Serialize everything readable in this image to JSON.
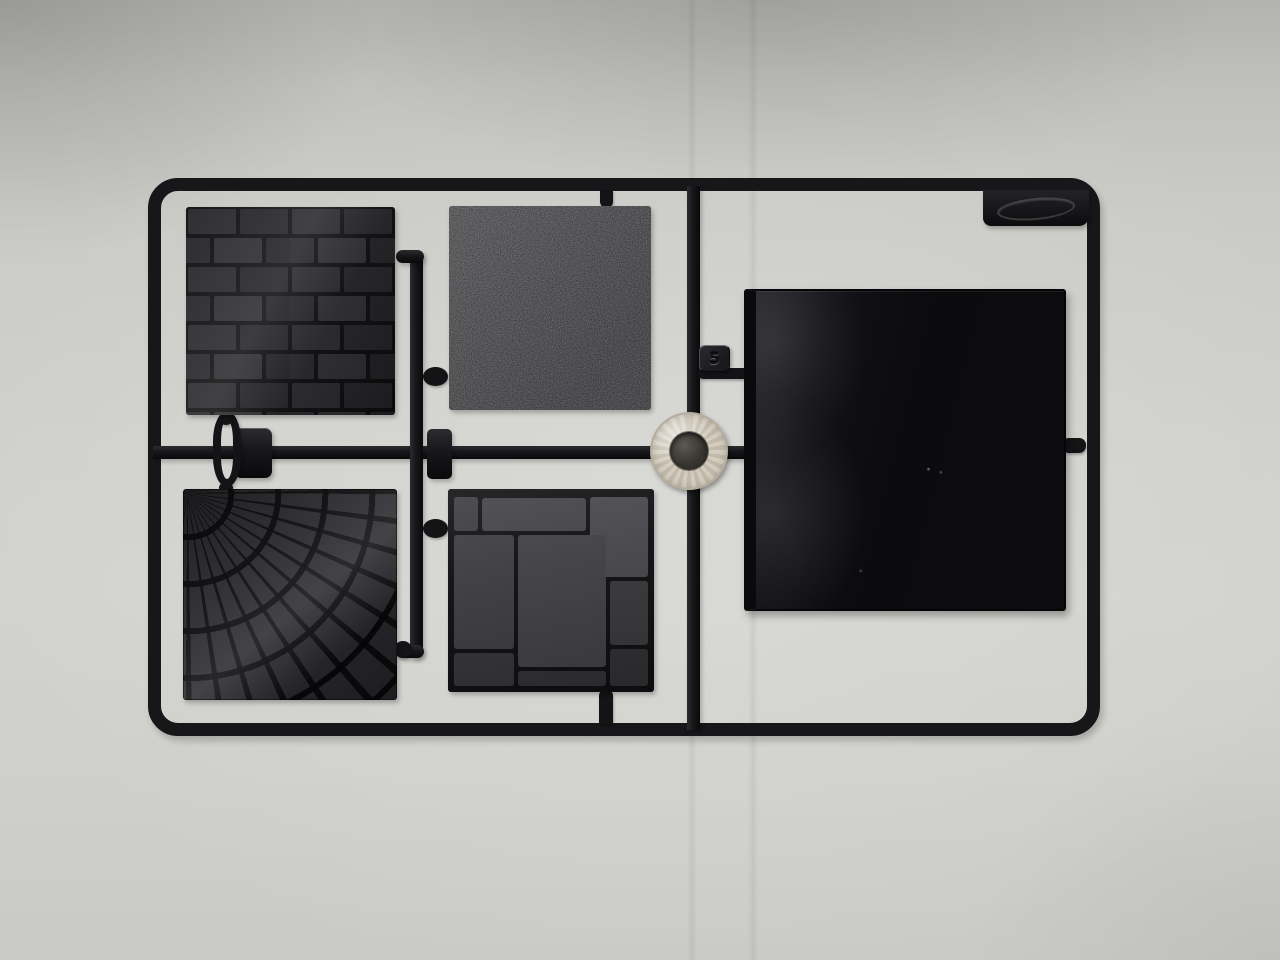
{
  "scene": {
    "description": "Photograph of a black injection-molded model-kit sprue holding five textured terrain tiles and one round ring part, lying on light grey paper",
    "background_color": "#cfcfcb",
    "sprue_color": "#17171a",
    "ring_color": "#d4cdbf"
  },
  "sprue": {
    "part_number_tag": "5",
    "brand_tab": {
      "emboss": "illegible embossed oval logo"
    },
    "parts": [
      {
        "id": "tile-brick-wall",
        "label": "brick wall texture tile"
      },
      {
        "id": "tile-rough-texture",
        "label": "rough stippled texture tile"
      },
      {
        "id": "tile-fan-cobblestone",
        "label": "fan-pattern cobblestone tile"
      },
      {
        "id": "tile-flagstone",
        "label": "flagstone paving tile"
      },
      {
        "id": "tile-plain-large",
        "label": "large smooth glossy tile"
      },
      {
        "id": "round-ring-part",
        "label": "round ring / washer part"
      }
    ]
  }
}
